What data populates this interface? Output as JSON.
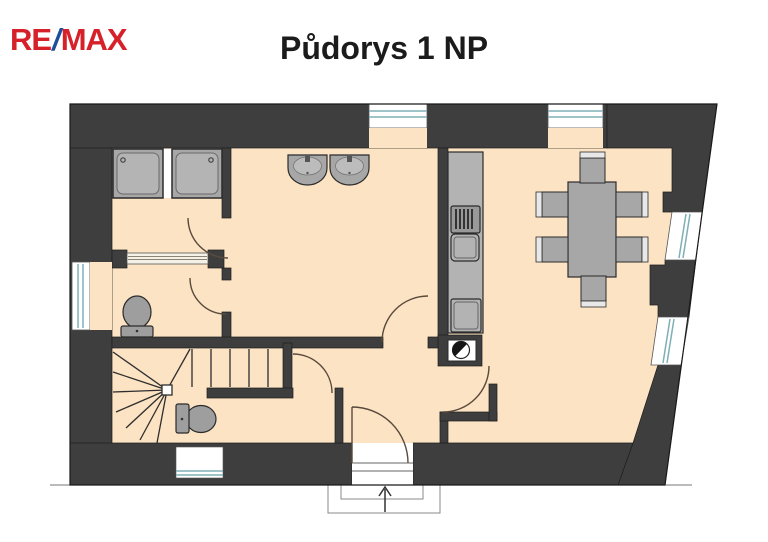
{
  "header": {
    "logo": {
      "re": "RE",
      "slash": "/",
      "max": "MAX"
    },
    "title": "Půdorys 1 NP"
  },
  "plan": {
    "colors": {
      "wall": "#3e3e3e",
      "floor": "#fbe3c3",
      "fixture_gray": "#a7a7a7",
      "fixture_light": "#e8e8e8",
      "window_glazing": "#7fafb5",
      "door_arc": "#5a4a3c",
      "logo_red": "#d6212a",
      "logo_blue": "#1d4f9c"
    },
    "fixtures": {
      "showers": 2,
      "washbasins": 2,
      "toilets": 2,
      "dining_table": 1,
      "dining_chairs": 6,
      "kitchen_counter": 1,
      "stove": 1,
      "kitchen_sink": 1,
      "boiler": 1,
      "staircase": 1,
      "windows": 6,
      "door_swings": 6
    },
    "entrance": {
      "direction": "up"
    }
  }
}
